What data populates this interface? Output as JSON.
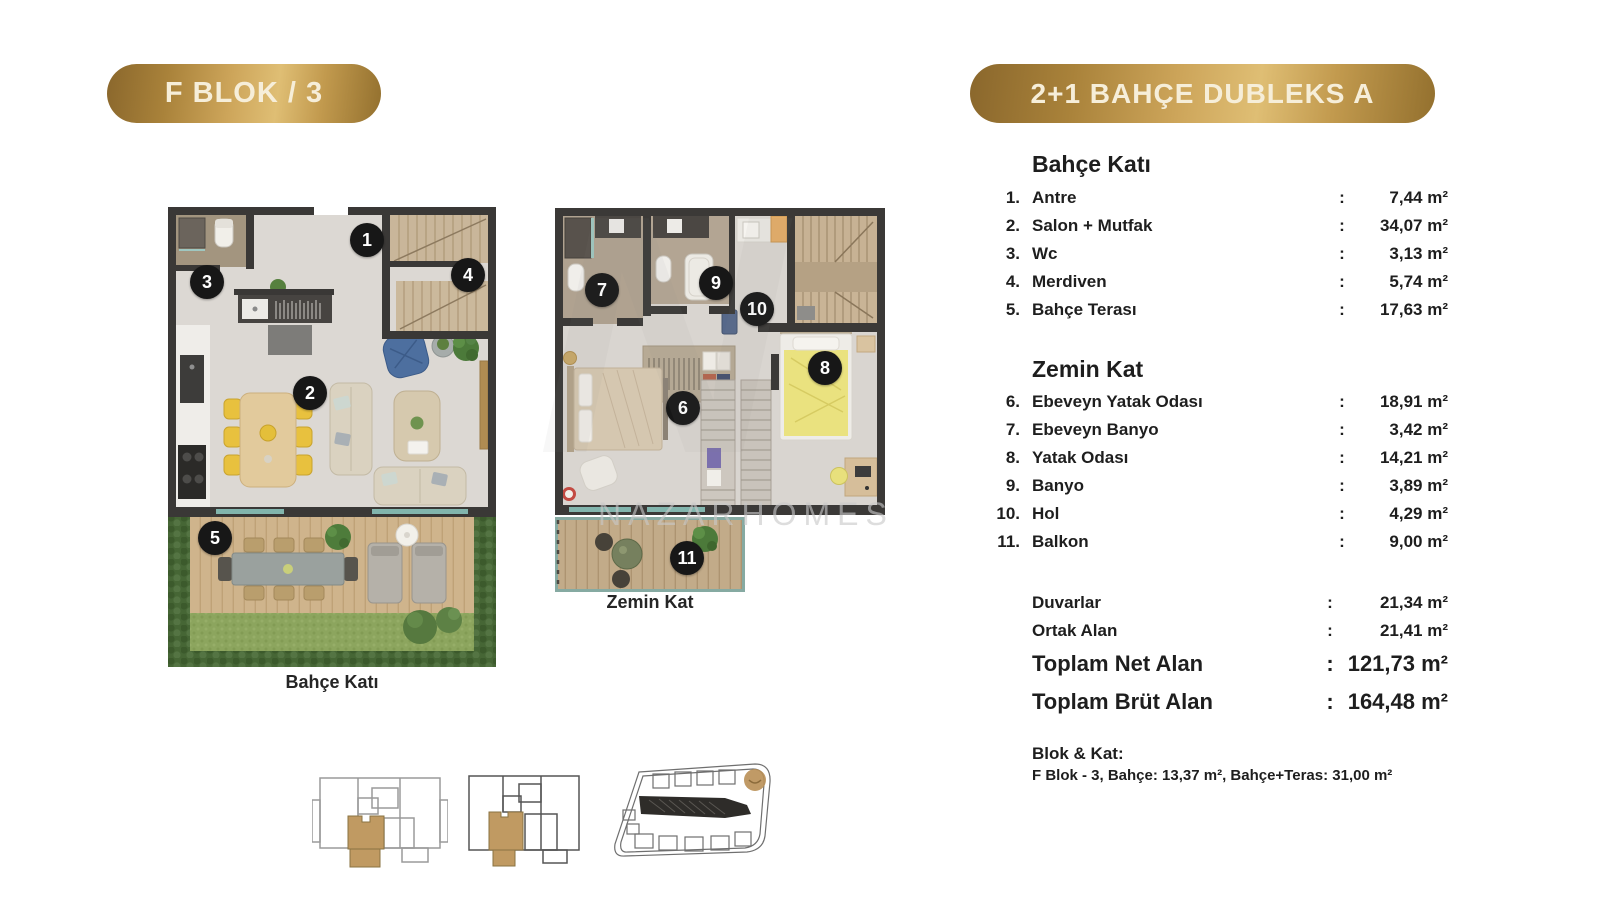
{
  "badges": {
    "left": "F BLOK / 3",
    "right": "2+1 BAHÇE DUBLEKS A"
  },
  "unit": "m²",
  "watermark": "NAZARHOMES",
  "watermark_letter": "N",
  "plans": [
    {
      "caption": "Bahçe Katı",
      "markers": [
        {
          "label": "1",
          "x": 199,
          "y": 33
        },
        {
          "label": "2",
          "x": 142,
          "y": 186
        },
        {
          "label": "3",
          "x": 39,
          "y": 75
        },
        {
          "label": "4",
          "x": 300,
          "y": 68
        },
        {
          "label": "5",
          "x": 47,
          "y": 331
        }
      ]
    },
    {
      "caption": "Zemin Kat",
      "markers": [
        {
          "label": "6",
          "x": 128,
          "y": 200
        },
        {
          "label": "7",
          "x": 47,
          "y": 82
        },
        {
          "label": "8",
          "x": 270,
          "y": 160
        },
        {
          "label": "9",
          "x": 161,
          "y": 75
        },
        {
          "label": "10",
          "x": 202,
          "y": 101
        },
        {
          "label": "11",
          "x": 132,
          "y": 350
        }
      ]
    }
  ],
  "panel": {
    "sections": [
      {
        "title": "Bahçe Katı",
        "rows": [
          {
            "num": "1.",
            "label": "Antre",
            "value": "7,44"
          },
          {
            "num": "2.",
            "label": "Salon + Mutfak",
            "value": "34,07"
          },
          {
            "num": "3.",
            "label": "Wc",
            "value": "3,13"
          },
          {
            "num": "4.",
            "label": "Merdiven",
            "value": "5,74"
          },
          {
            "num": "5.",
            "label": "Bahçe Terası",
            "value": "17,63"
          }
        ]
      },
      {
        "title": "Zemin Kat",
        "rows": [
          {
            "num": "6.",
            "label": "Ebeveyn Yatak Odası",
            "value": "18,91"
          },
          {
            "num": "7.",
            "label": "Ebeveyn Banyo",
            "value": "3,42"
          },
          {
            "num": "8.",
            "label": "Yatak Odası",
            "value": "14,21"
          },
          {
            "num": "9.",
            "label": "Banyo",
            "value": "3,89"
          },
          {
            "num": "10.",
            "label": "Hol",
            "value": "4,29"
          },
          {
            "num": "11.",
            "label": "Balkon",
            "value": "9,00"
          }
        ]
      }
    ],
    "summary": [
      {
        "label": "Duvarlar",
        "value": "21,34",
        "size": "small"
      },
      {
        "label": "Ortak Alan",
        "value": "21,41",
        "size": "small"
      },
      {
        "label": "Toplam Net Alan",
        "value": "121,73",
        "size": "large"
      },
      {
        "label": "Toplam Brüt Alan",
        "value": "164,48",
        "size": "large"
      }
    ],
    "footer": {
      "title": "Blok & Kat:",
      "line": "F Blok - 3, Bahçe: 13,37 m², Bahçe+Teras: 31,00 m²"
    }
  },
  "colors": {
    "gold_dark": "#8a672c",
    "gold_light": "#dfbe74",
    "marker": "#171717",
    "text": "#1e1e1e"
  }
}
